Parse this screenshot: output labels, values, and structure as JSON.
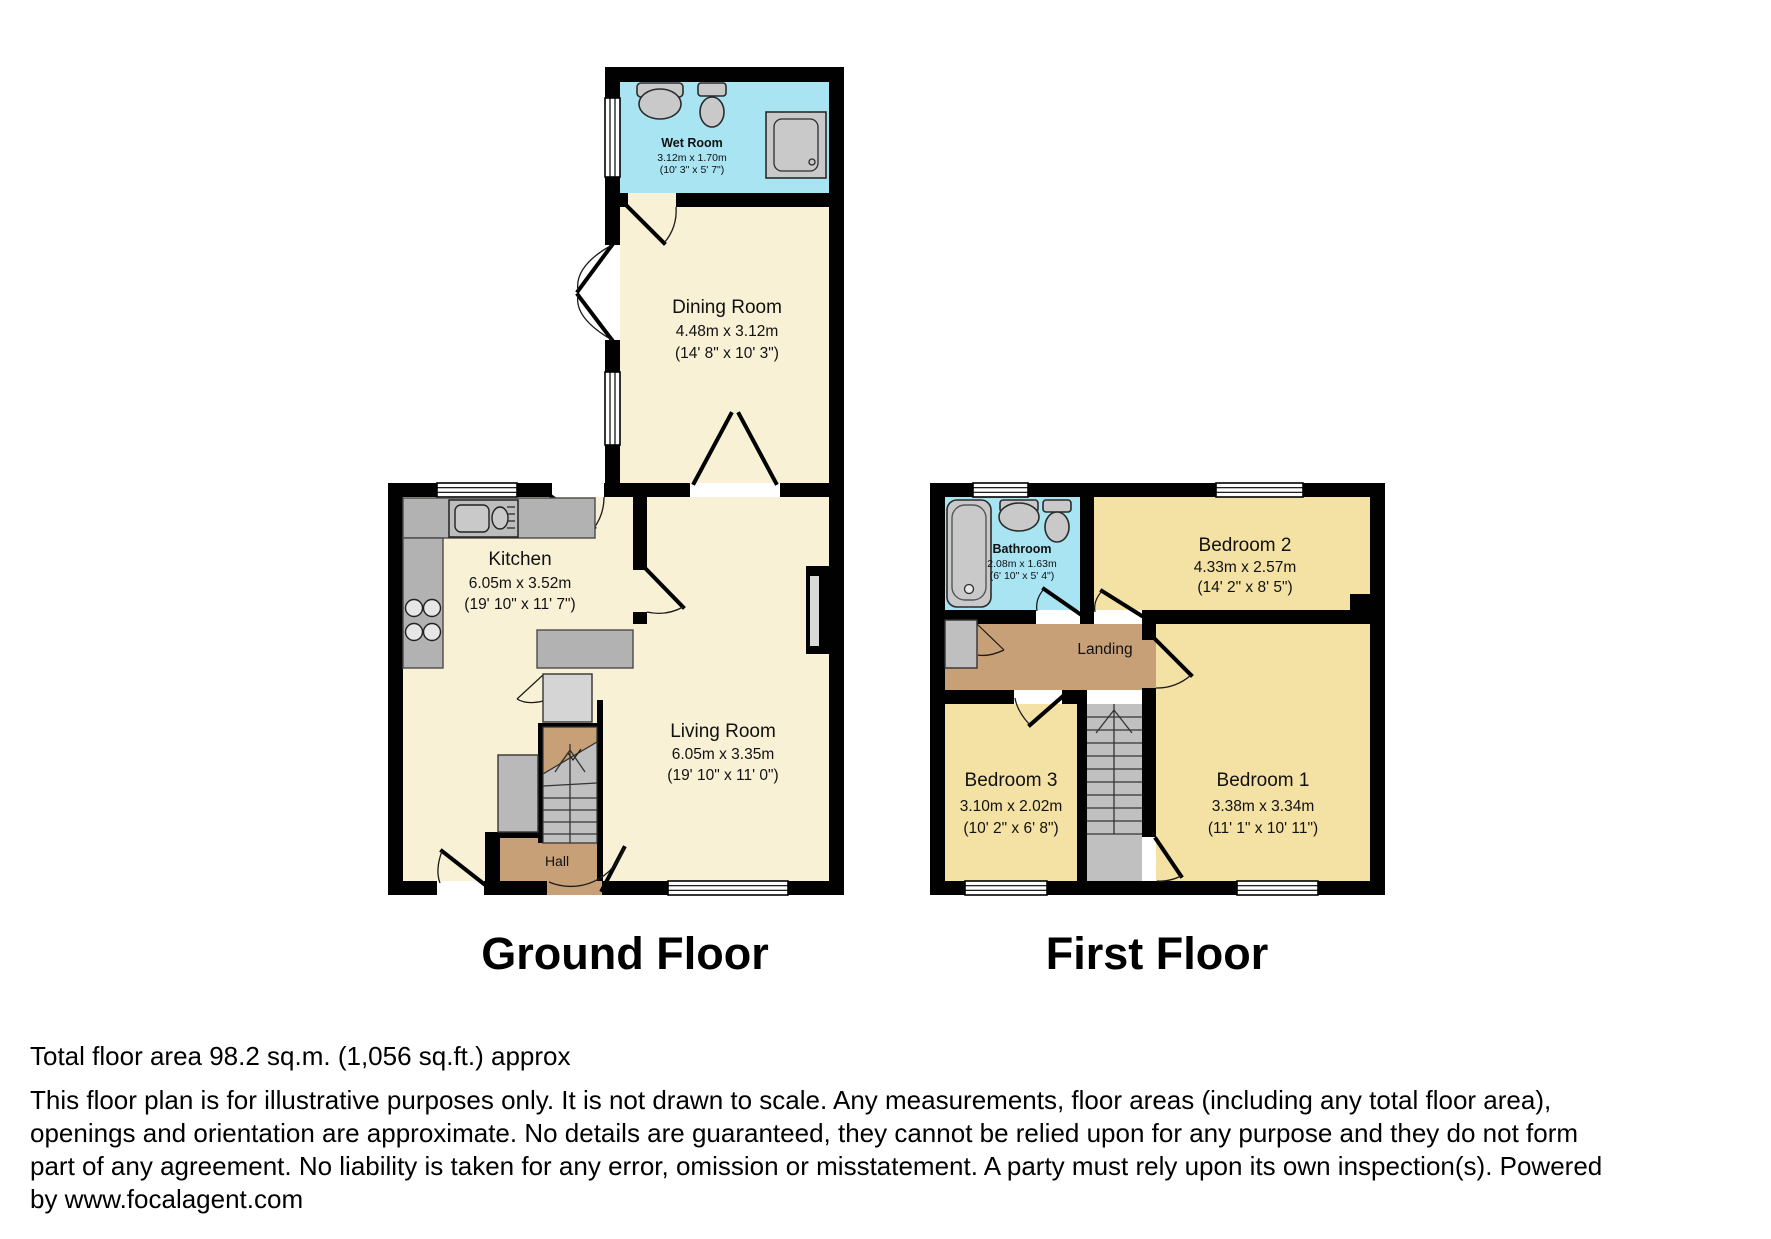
{
  "ground_floor": {
    "title": "Ground Floor",
    "rooms": {
      "wet_room": {
        "name": "Wet Room",
        "dims_m": "3.12m x 1.70m",
        "dims_ft": "(10' 3\" x 5' 7\")"
      },
      "dining_room": {
        "name": "Dining Room",
        "dims_m": "4.48m x 3.12m",
        "dims_ft": "(14' 8\" x 10' 3\")"
      },
      "kitchen": {
        "name": "Kitchen",
        "dims_m": "6.05m x 3.52m",
        "dims_ft": "(19' 10\" x 11' 7\")"
      },
      "living_room": {
        "name": "Living Room",
        "dims_m": "6.05m x 3.35m",
        "dims_ft": "(19' 10\" x 11' 0\")"
      },
      "hall": {
        "name": "Hall"
      }
    }
  },
  "first_floor": {
    "title": "First Floor",
    "rooms": {
      "bathroom": {
        "name": "Bathroom",
        "dims_m": "2.08m x 1.63m",
        "dims_ft": "(6' 10\" x 5' 4\")"
      },
      "bedroom_2": {
        "name": "Bedroom 2",
        "dims_m": "4.33m x 2.57m",
        "dims_ft": "(14' 2\" x 8' 5\")"
      },
      "landing": {
        "name": "Landing"
      },
      "bedroom_3": {
        "name": "Bedroom 3",
        "dims_m": "3.10m x 2.02m",
        "dims_ft": "(10' 2\" x 6' 8\")"
      },
      "bedroom_1": {
        "name": "Bedroom 1",
        "dims_m": "3.38m x 3.34m",
        "dims_ft": "(11' 1\" x 10' 11\")"
      }
    }
  },
  "footer": {
    "total_area": "Total floor area 98.2 sq.m. (1,056 sq.ft.) approx",
    "disclaimer_lines": [
      "This floor plan is for illustrative purposes only. It is not drawn to scale. Any measurements, floor areas (including any total floor area),",
      "openings and orientation are approximate. No details are guaranteed, they cannot be relied upon for any purpose and they do not form",
      "part of any agreement. No liability is taken for any error, omission or misstatement. A party must rely upon its own inspection(s). Powered",
      "by www.focalagent.com"
    ]
  },
  "colors": {
    "wall": "#010101",
    "ground_room_fill": "#f8f1d6",
    "wet_area_fill": "#a8e4f2",
    "bedroom_fill": "#f4e1a4",
    "hall_landing_fill": "#c7a077",
    "counter_fill": "#b2b2b2",
    "stairs_fill": "#c0c0c0"
  }
}
